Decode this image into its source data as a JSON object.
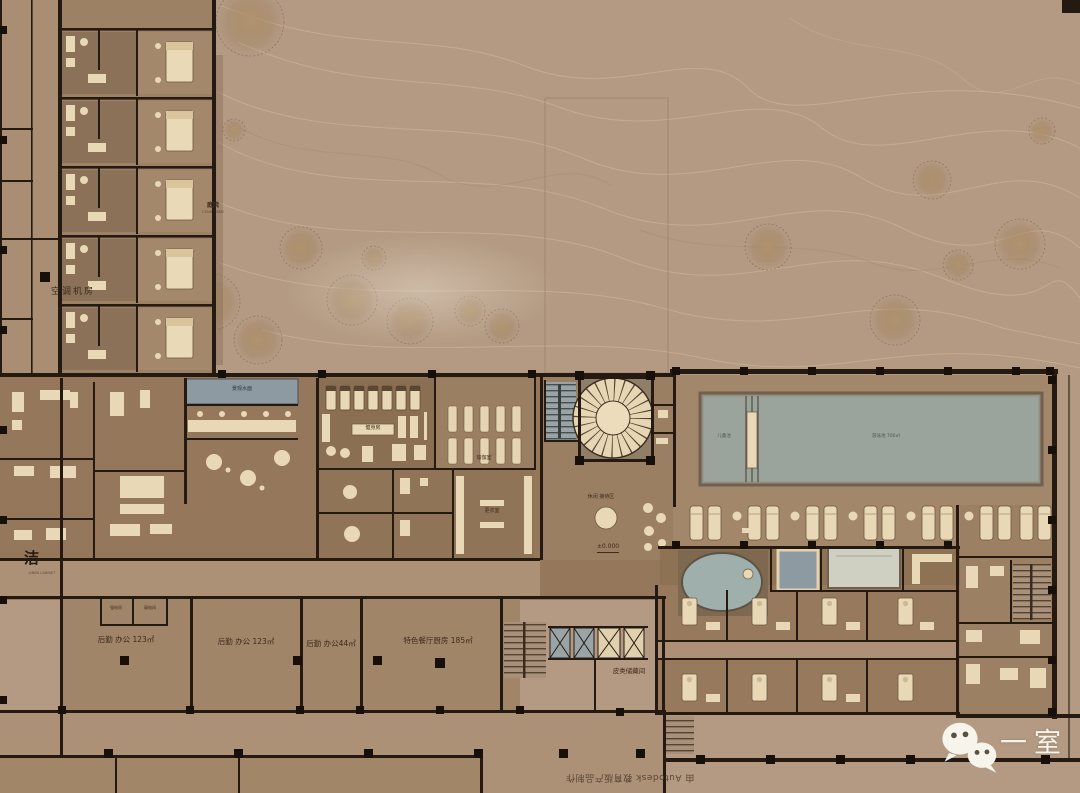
{
  "colors": {
    "ground": "#b49a82",
    "floor_dark": "#8a6f53",
    "floor_mid": "#977a5e",
    "floor_light": "#ad9177",
    "wall": "#241a12",
    "cream": "#e9d8b6",
    "pool_water": "#9aa49c",
    "tub_water": "#8d9aa2",
    "logo_white": "#f7f4ec"
  },
  "labels": {
    "hvac": "空调机房",
    "courtyard": "庭院",
    "courtyard_sub": "COURTYARD",
    "water_feature": "景观水面",
    "gym": "健身房",
    "yoga": "瑜伽室",
    "lockers": "更衣室",
    "lobby": "休闲 接待区",
    "level_marker": "±0.000",
    "kids_pool": "儿童池",
    "main_pool": "游泳池 700㎡",
    "linen": "洁",
    "linen_sub": "LINEN CABINET",
    "elec_room_1": "强电间",
    "elec_room_2": "弱电间",
    "boh_office_1": "后勤 办公 123㎡",
    "boh_office_2": "后勤 办公 123㎡",
    "boh_office_3": "后勤 办公44㎡",
    "kitchen": "特色餐厅厨房 185㎡",
    "leather_storage": "皮类储藏间"
  },
  "watermark": "由 Autodesk 教育版产品制作",
  "logo": {
    "text": "一室"
  }
}
